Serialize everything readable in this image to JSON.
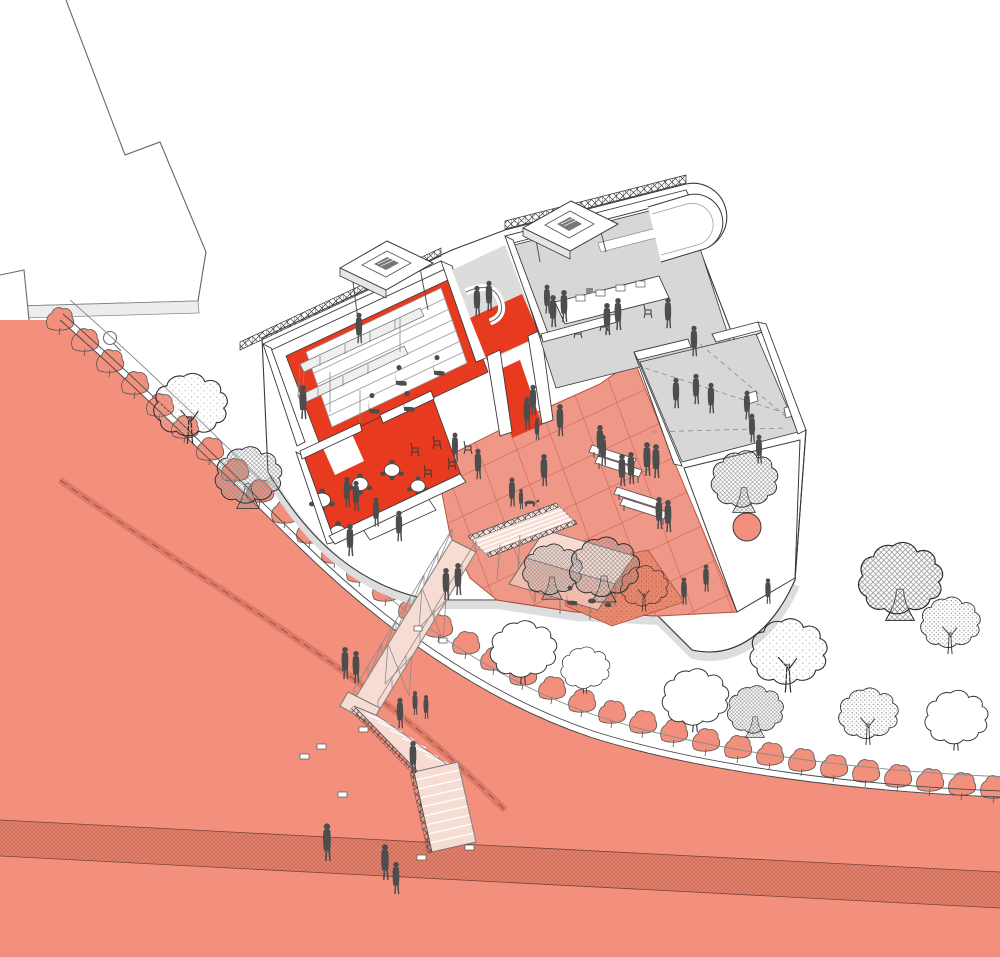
{
  "meta": {
    "title": "Axonometric site illustration — waterfront cultural building with plaza, footbridge and beach slope",
    "drawing_type": "architectural cutaway axonometric",
    "canvas": {
      "width": 1000,
      "height": 957
    }
  },
  "colors": {
    "background": "#FFFFFF",
    "slope": "#F2907D",
    "slope_band": "#E5816C",
    "hedge": "#F2907D",
    "plaza": "#EF9887",
    "plaza_grid": "#C65A44",
    "planting_bed": "#E8886F",
    "red_floor": "#E73A1E",
    "red_carpet": "#E73A1E",
    "room_floor_gray": "#D7D7D7",
    "wall_white": "#FFFFFF",
    "wall_shade": "#E2E2E2",
    "outline": "#3A3A3A",
    "bridge_deck": "#F7DCD4",
    "pavilion_roof_light": "#F7DBD3",
    "pavilion_roof_dark": "#EFBCAE",
    "structure_gray": "#8A8A8A",
    "figure": "#4D4D4D",
    "tree_outline": "#2B2B2B"
  },
  "scene": {
    "setting": "Cutaway axonometric of a public cultural building on a curved promenade above a beach slope",
    "areas": [
      {
        "id": "existing-building",
        "label": "Existing building (outline, top-left)"
      },
      {
        "id": "beach-slope",
        "label": "Beach slope (salmon)"
      },
      {
        "id": "slope-path-band",
        "label": "Hatched path band across slope"
      },
      {
        "id": "promenade",
        "label": "Curved promenade with retaining wall"
      },
      {
        "id": "hedge-row",
        "label": "Hedge row of shrubs along promenade"
      },
      {
        "id": "auditorium",
        "label": "Auditorium with stepped seating and catwalk (red floor)"
      },
      {
        "id": "cafe",
        "label": "Café with round tables (red floor)"
      },
      {
        "id": "workshop",
        "label": "Workshop room with long table (gray floor)"
      },
      {
        "id": "gallery",
        "label": "Gallery room with sightlines (gray floor)"
      },
      {
        "id": "plaza",
        "label": "Tiled public plaza (salmon grid)"
      },
      {
        "id": "paving",
        "label": "White paving strip with tree planter"
      },
      {
        "id": "footbridge",
        "label": "Scaffold footbridge and stairs down to beach"
      },
      {
        "id": "pavilion",
        "label": "Pavilion with pink shed roof"
      },
      {
        "id": "tree-grove",
        "label": "Tree grove (right)"
      }
    ],
    "counts": {
      "people_standing": 52,
      "people_seated": 5,
      "trees": 14,
      "hedge_shrubs": 34,
      "benches": 2,
      "cafe_tables": 5,
      "plaza_chairs": 5,
      "skylight_monitors": 2,
      "dogs": 1,
      "cats": 2
    }
  }
}
